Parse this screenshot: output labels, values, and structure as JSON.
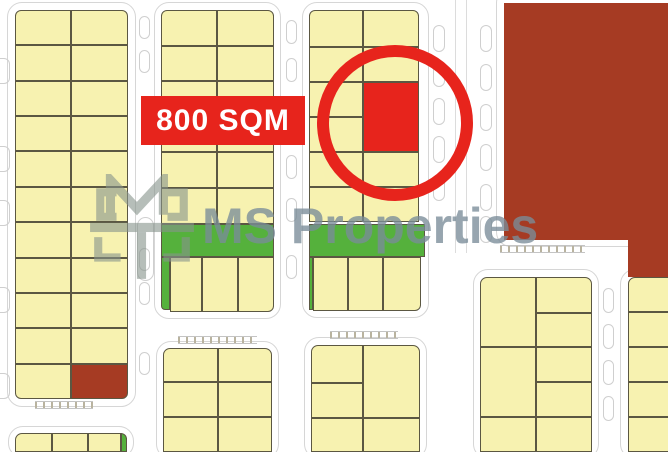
{
  "badge": {
    "label": "800 SQM",
    "bg_color": "#e7241c",
    "text_color": "#ffffff"
  },
  "watermark": {
    "text": "MS Properties",
    "logo_icon": "ms-monogram-icon",
    "color": "#7a8d99"
  },
  "highlight": {
    "shape": "circle",
    "color": "#e7241c"
  },
  "palette": {
    "c": "#f7f2b0",
    "g": "#55b13c",
    "r": "#e7241c",
    "d": "#a63b23",
    "dd": "#7e2c18"
  },
  "map": {
    "zones": [
      {
        "n": "district-dark-red",
        "x": 504,
        "y": 3,
        "w": 164,
        "h": 237,
        "f": "d"
      },
      {
        "n": "district-divider",
        "x": 504,
        "y": 138,
        "w": 164,
        "h": 2,
        "f": "dd"
      },
      {
        "n": "district-dark-red-ext",
        "x": 628,
        "y": 240,
        "w": 40,
        "h": 37,
        "f": "d"
      }
    ],
    "road_outlines": [
      {
        "x": 7,
        "y": 2,
        "w": 129,
        "h": 405
      },
      {
        "x": 154,
        "y": 2,
        "w": 127,
        "h": 317
      },
      {
        "x": 302,
        "y": 2,
        "w": 127,
        "h": 316
      },
      {
        "x": 496,
        "y": -12,
        "w": 200,
        "h": 259
      },
      {
        "x": 156,
        "y": 341,
        "w": 123,
        "h": 118
      },
      {
        "x": 304,
        "y": 337,
        "w": 123,
        "h": 122
      },
      {
        "x": 473,
        "y": 269,
        "w": 126,
        "h": 190
      },
      {
        "x": 620,
        "y": 269,
        "w": 60,
        "h": 190
      },
      {
        "x": 8,
        "y": 426,
        "w": 126,
        "h": 32
      }
    ],
    "road_lines": [
      {
        "x": 455,
        "y": 0,
        "w": 1,
        "h": 253
      },
      {
        "x": 466,
        "y": 0,
        "w": 1,
        "h": 253
      }
    ],
    "parking_bays": [
      {
        "x": -7,
        "y": 58,
        "w": 17,
        "h": 26
      },
      {
        "x": -7,
        "y": 146,
        "w": 17,
        "h": 26
      },
      {
        "x": -7,
        "y": 200,
        "w": 17,
        "h": 26
      },
      {
        "x": -7,
        "y": 287,
        "w": 17,
        "h": 26
      },
      {
        "x": -7,
        "y": 373,
        "w": 17,
        "h": 26
      },
      {
        "x": 139,
        "y": 16,
        "w": 11,
        "h": 23
      },
      {
        "x": 139,
        "y": 50,
        "w": 11,
        "h": 23
      },
      {
        "x": 139,
        "y": 248,
        "w": 11,
        "h": 23
      },
      {
        "x": 139,
        "y": 282,
        "w": 11,
        "h": 23
      },
      {
        "x": 139,
        "y": 352,
        "w": 11,
        "h": 23
      },
      {
        "x": 137,
        "y": 217,
        "w": 17,
        "h": 64,
        "r": "9px"
      },
      {
        "x": 286,
        "y": 20,
        "w": 11,
        "h": 24
      },
      {
        "x": 286,
        "y": 58,
        "w": 11,
        "h": 24
      },
      {
        "x": 286,
        "y": 155,
        "w": 11,
        "h": 24
      },
      {
        "x": 286,
        "y": 198,
        "w": 11,
        "h": 24
      },
      {
        "x": 286,
        "y": 255,
        "w": 11,
        "h": 24
      },
      {
        "x": 433,
        "y": 25,
        "w": 12,
        "h": 27
      },
      {
        "x": 433,
        "y": 60,
        "w": 12,
        "h": 27
      },
      {
        "x": 433,
        "y": 98,
        "w": 12,
        "h": 27
      },
      {
        "x": 433,
        "y": 136,
        "w": 12,
        "h": 27
      },
      {
        "x": 433,
        "y": 174,
        "w": 12,
        "h": 27
      },
      {
        "x": 480,
        "y": 25,
        "w": 12,
        "h": 27
      },
      {
        "x": 480,
        "y": 64,
        "w": 12,
        "h": 27
      },
      {
        "x": 480,
        "y": 104,
        "w": 12,
        "h": 27
      },
      {
        "x": 480,
        "y": 144,
        "w": 12,
        "h": 27
      },
      {
        "x": 480,
        "y": 184,
        "w": 12,
        "h": 27
      },
      {
        "x": 480,
        "y": 216,
        "w": 12,
        "h": 27
      },
      {
        "x": 603,
        "y": 288,
        "w": 11,
        "h": 25
      },
      {
        "x": 603,
        "y": 324,
        "w": 11,
        "h": 25
      },
      {
        "x": 603,
        "y": 360,
        "w": 11,
        "h": 25
      },
      {
        "x": 603,
        "y": 396,
        "w": 11,
        "h": 25
      }
    ],
    "crosswalks": [
      {
        "x": 35,
        "y": 401,
        "w": 58,
        "h": 8
      },
      {
        "x": 500,
        "y": 245,
        "w": 85,
        "h": 8
      },
      {
        "x": 330,
        "y": 331,
        "w": 68,
        "h": 8
      },
      {
        "x": 178,
        "y": 336,
        "w": 79,
        "h": 8
      }
    ],
    "blocks": [
      {
        "name": "block-a",
        "plots": [
          {
            "x": 15,
            "y": 10,
            "w": 56,
            "h": 35,
            "r": "6px 0 0 0"
          },
          {
            "x": 71,
            "y": 10,
            "w": 57,
            "h": 35,
            "r": "0 6px 0 0"
          },
          {
            "x": 15,
            "y": 45,
            "w": 56,
            "h": 36
          },
          {
            "x": 71,
            "y": 45,
            "w": 57,
            "h": 36
          },
          {
            "x": 15,
            "y": 81,
            "w": 56,
            "h": 35
          },
          {
            "x": 71,
            "y": 81,
            "w": 57,
            "h": 35
          },
          {
            "x": 15,
            "y": 116,
            "w": 56,
            "h": 35
          },
          {
            "x": 71,
            "y": 116,
            "w": 57,
            "h": 35
          },
          {
            "x": 15,
            "y": 151,
            "w": 56,
            "h": 36
          },
          {
            "x": 71,
            "y": 151,
            "w": 57,
            "h": 36
          },
          {
            "x": 15,
            "y": 187,
            "w": 56,
            "h": 35
          },
          {
            "x": 71,
            "y": 187,
            "w": 57,
            "h": 35
          },
          {
            "x": 15,
            "y": 222,
            "w": 56,
            "h": 36
          },
          {
            "x": 71,
            "y": 222,
            "w": 57,
            "h": 36
          },
          {
            "x": 15,
            "y": 258,
            "w": 56,
            "h": 35
          },
          {
            "x": 71,
            "y": 258,
            "w": 57,
            "h": 35
          },
          {
            "x": 15,
            "y": 293,
            "w": 56,
            "h": 35
          },
          {
            "x": 71,
            "y": 293,
            "w": 57,
            "h": 35
          },
          {
            "x": 15,
            "y": 328,
            "w": 56,
            "h": 36
          },
          {
            "x": 71,
            "y": 328,
            "w": 57,
            "h": 36
          },
          {
            "x": 15,
            "y": 364,
            "w": 56,
            "h": 35,
            "r": "0 0 0 6px"
          },
          {
            "x": 71,
            "y": 364,
            "w": 57,
            "h": 35,
            "f": "d",
            "r": "0 0 6px 0"
          }
        ]
      },
      {
        "name": "block-b",
        "plots": [
          {
            "x": 161,
            "y": 10,
            "w": 56,
            "h": 36,
            "r": "6px 0 0 0"
          },
          {
            "x": 217,
            "y": 10,
            "w": 57,
            "h": 36,
            "r": "0 6px 0 0"
          },
          {
            "x": 161,
            "y": 46,
            "w": 56,
            "h": 35
          },
          {
            "x": 217,
            "y": 46,
            "w": 57,
            "h": 35
          },
          {
            "x": 161,
            "y": 81,
            "w": 56,
            "h": 36
          },
          {
            "x": 217,
            "y": 81,
            "w": 57,
            "h": 36
          },
          {
            "x": 161,
            "y": 117,
            "w": 56,
            "h": 35
          },
          {
            "x": 217,
            "y": 117,
            "w": 57,
            "h": 35
          },
          {
            "x": 161,
            "y": 152,
            "w": 56,
            "h": 36
          },
          {
            "x": 217,
            "y": 152,
            "w": 57,
            "h": 36
          },
          {
            "x": 161,
            "y": 188,
            "w": 56,
            "h": 36
          },
          {
            "x": 217,
            "y": 188,
            "w": 57,
            "h": 36
          },
          {
            "x": 161,
            "y": 224,
            "w": 113,
            "h": 33,
            "f": "g"
          },
          {
            "x": 161,
            "y": 257,
            "w": 9,
            "h": 53,
            "f": "g",
            "r": "0 0 0 4px"
          },
          {
            "x": 170,
            "y": 257,
            "w": 32,
            "h": 55
          },
          {
            "x": 202,
            "y": 257,
            "w": 36,
            "h": 55
          },
          {
            "x": 238,
            "y": 257,
            "w": 36,
            "h": 55,
            "r": "0 0 6px 0"
          }
        ]
      },
      {
        "name": "block-c",
        "plots": [
          {
            "x": 309,
            "y": 10,
            "w": 54,
            "h": 37,
            "r": "6px 0 0 0"
          },
          {
            "x": 363,
            "y": 10,
            "w": 56,
            "h": 37,
            "r": "0 6px 0 0"
          },
          {
            "x": 309,
            "y": 47,
            "w": 54,
            "h": 35
          },
          {
            "x": 363,
            "y": 47,
            "w": 56,
            "h": 35
          },
          {
            "x": 309,
            "y": 82,
            "w": 54,
            "h": 35
          },
          {
            "x": 363,
            "y": 82,
            "w": 56,
            "h": 70,
            "f": "r"
          },
          {
            "x": 309,
            "y": 117,
            "w": 54,
            "h": 35
          },
          {
            "x": 309,
            "y": 152,
            "w": 54,
            "h": 35
          },
          {
            "x": 363,
            "y": 152,
            "w": 56,
            "h": 35
          },
          {
            "x": 309,
            "y": 187,
            "w": 54,
            "h": 35
          },
          {
            "x": 363,
            "y": 187,
            "w": 56,
            "h": 35
          },
          {
            "x": 309,
            "y": 224,
            "w": 116,
            "h": 33,
            "f": "g"
          },
          {
            "x": 309,
            "y": 257,
            "w": 4,
            "h": 53,
            "f": "g"
          },
          {
            "x": 313,
            "y": 257,
            "w": 35,
            "h": 54
          },
          {
            "x": 348,
            "y": 257,
            "w": 35,
            "h": 54
          },
          {
            "x": 383,
            "y": 257,
            "w": 38,
            "h": 54,
            "r": "0 0 6px 0"
          }
        ]
      },
      {
        "name": "block-d",
        "plots": [
          {
            "x": 163,
            "y": 348,
            "w": 55,
            "h": 34,
            "r": "7px 0 0 0"
          },
          {
            "x": 218,
            "y": 348,
            "w": 54,
            "h": 34,
            "r": "0 7px 0 0"
          },
          {
            "x": 163,
            "y": 382,
            "w": 55,
            "h": 35
          },
          {
            "x": 218,
            "y": 382,
            "w": 54,
            "h": 35
          },
          {
            "x": 163,
            "y": 417,
            "w": 55,
            "h": 35
          },
          {
            "x": 218,
            "y": 417,
            "w": 54,
            "h": 35
          }
        ]
      },
      {
        "name": "block-e",
        "plots": [
          {
            "x": 311,
            "y": 345,
            "w": 52,
            "h": 38,
            "r": "7px 0 0 0"
          },
          {
            "x": 311,
            "y": 383,
            "w": 52,
            "h": 35
          },
          {
            "x": 311,
            "y": 418,
            "w": 52,
            "h": 34
          },
          {
            "x": 363,
            "y": 345,
            "w": 57,
            "h": 73,
            "r": "0 7px 0 0"
          },
          {
            "x": 363,
            "y": 418,
            "w": 57,
            "h": 34
          }
        ]
      },
      {
        "name": "block-f",
        "plots": [
          {
            "x": 480,
            "y": 277,
            "w": 56,
            "h": 70,
            "r": "7px 0 0 0"
          },
          {
            "x": 480,
            "y": 347,
            "w": 56,
            "h": 70
          },
          {
            "x": 480,
            "y": 417,
            "w": 56,
            "h": 35
          },
          {
            "x": 536,
            "y": 277,
            "w": 56,
            "h": 36,
            "r": "0 7px 0 0"
          },
          {
            "x": 536,
            "y": 313,
            "w": 56,
            "h": 34
          },
          {
            "x": 536,
            "y": 347,
            "w": 56,
            "h": 35
          },
          {
            "x": 536,
            "y": 382,
            "w": 56,
            "h": 35
          },
          {
            "x": 536,
            "y": 417,
            "w": 56,
            "h": 35
          }
        ]
      },
      {
        "name": "block-g",
        "plots": [
          {
            "x": 628,
            "y": 277,
            "w": 44,
            "h": 35,
            "r": "7px 0 0 0"
          },
          {
            "x": 628,
            "y": 312,
            "w": 44,
            "h": 35
          },
          {
            "x": 628,
            "y": 347,
            "w": 44,
            "h": 35
          },
          {
            "x": 628,
            "y": 382,
            "w": 44,
            "h": 35
          },
          {
            "x": 628,
            "y": 417,
            "w": 44,
            "h": 35
          }
        ]
      },
      {
        "name": "block-h",
        "plots": [
          {
            "x": 15,
            "y": 433,
            "w": 37,
            "h": 19,
            "r": "7px 0 0 0"
          },
          {
            "x": 52,
            "y": 433,
            "w": 36,
            "h": 19
          },
          {
            "x": 88,
            "y": 433,
            "w": 33,
            "h": 19
          },
          {
            "x": 121,
            "y": 433,
            "w": 6,
            "h": 19,
            "f": "g",
            "r": "0 7px 0 0"
          }
        ]
      }
    ]
  }
}
